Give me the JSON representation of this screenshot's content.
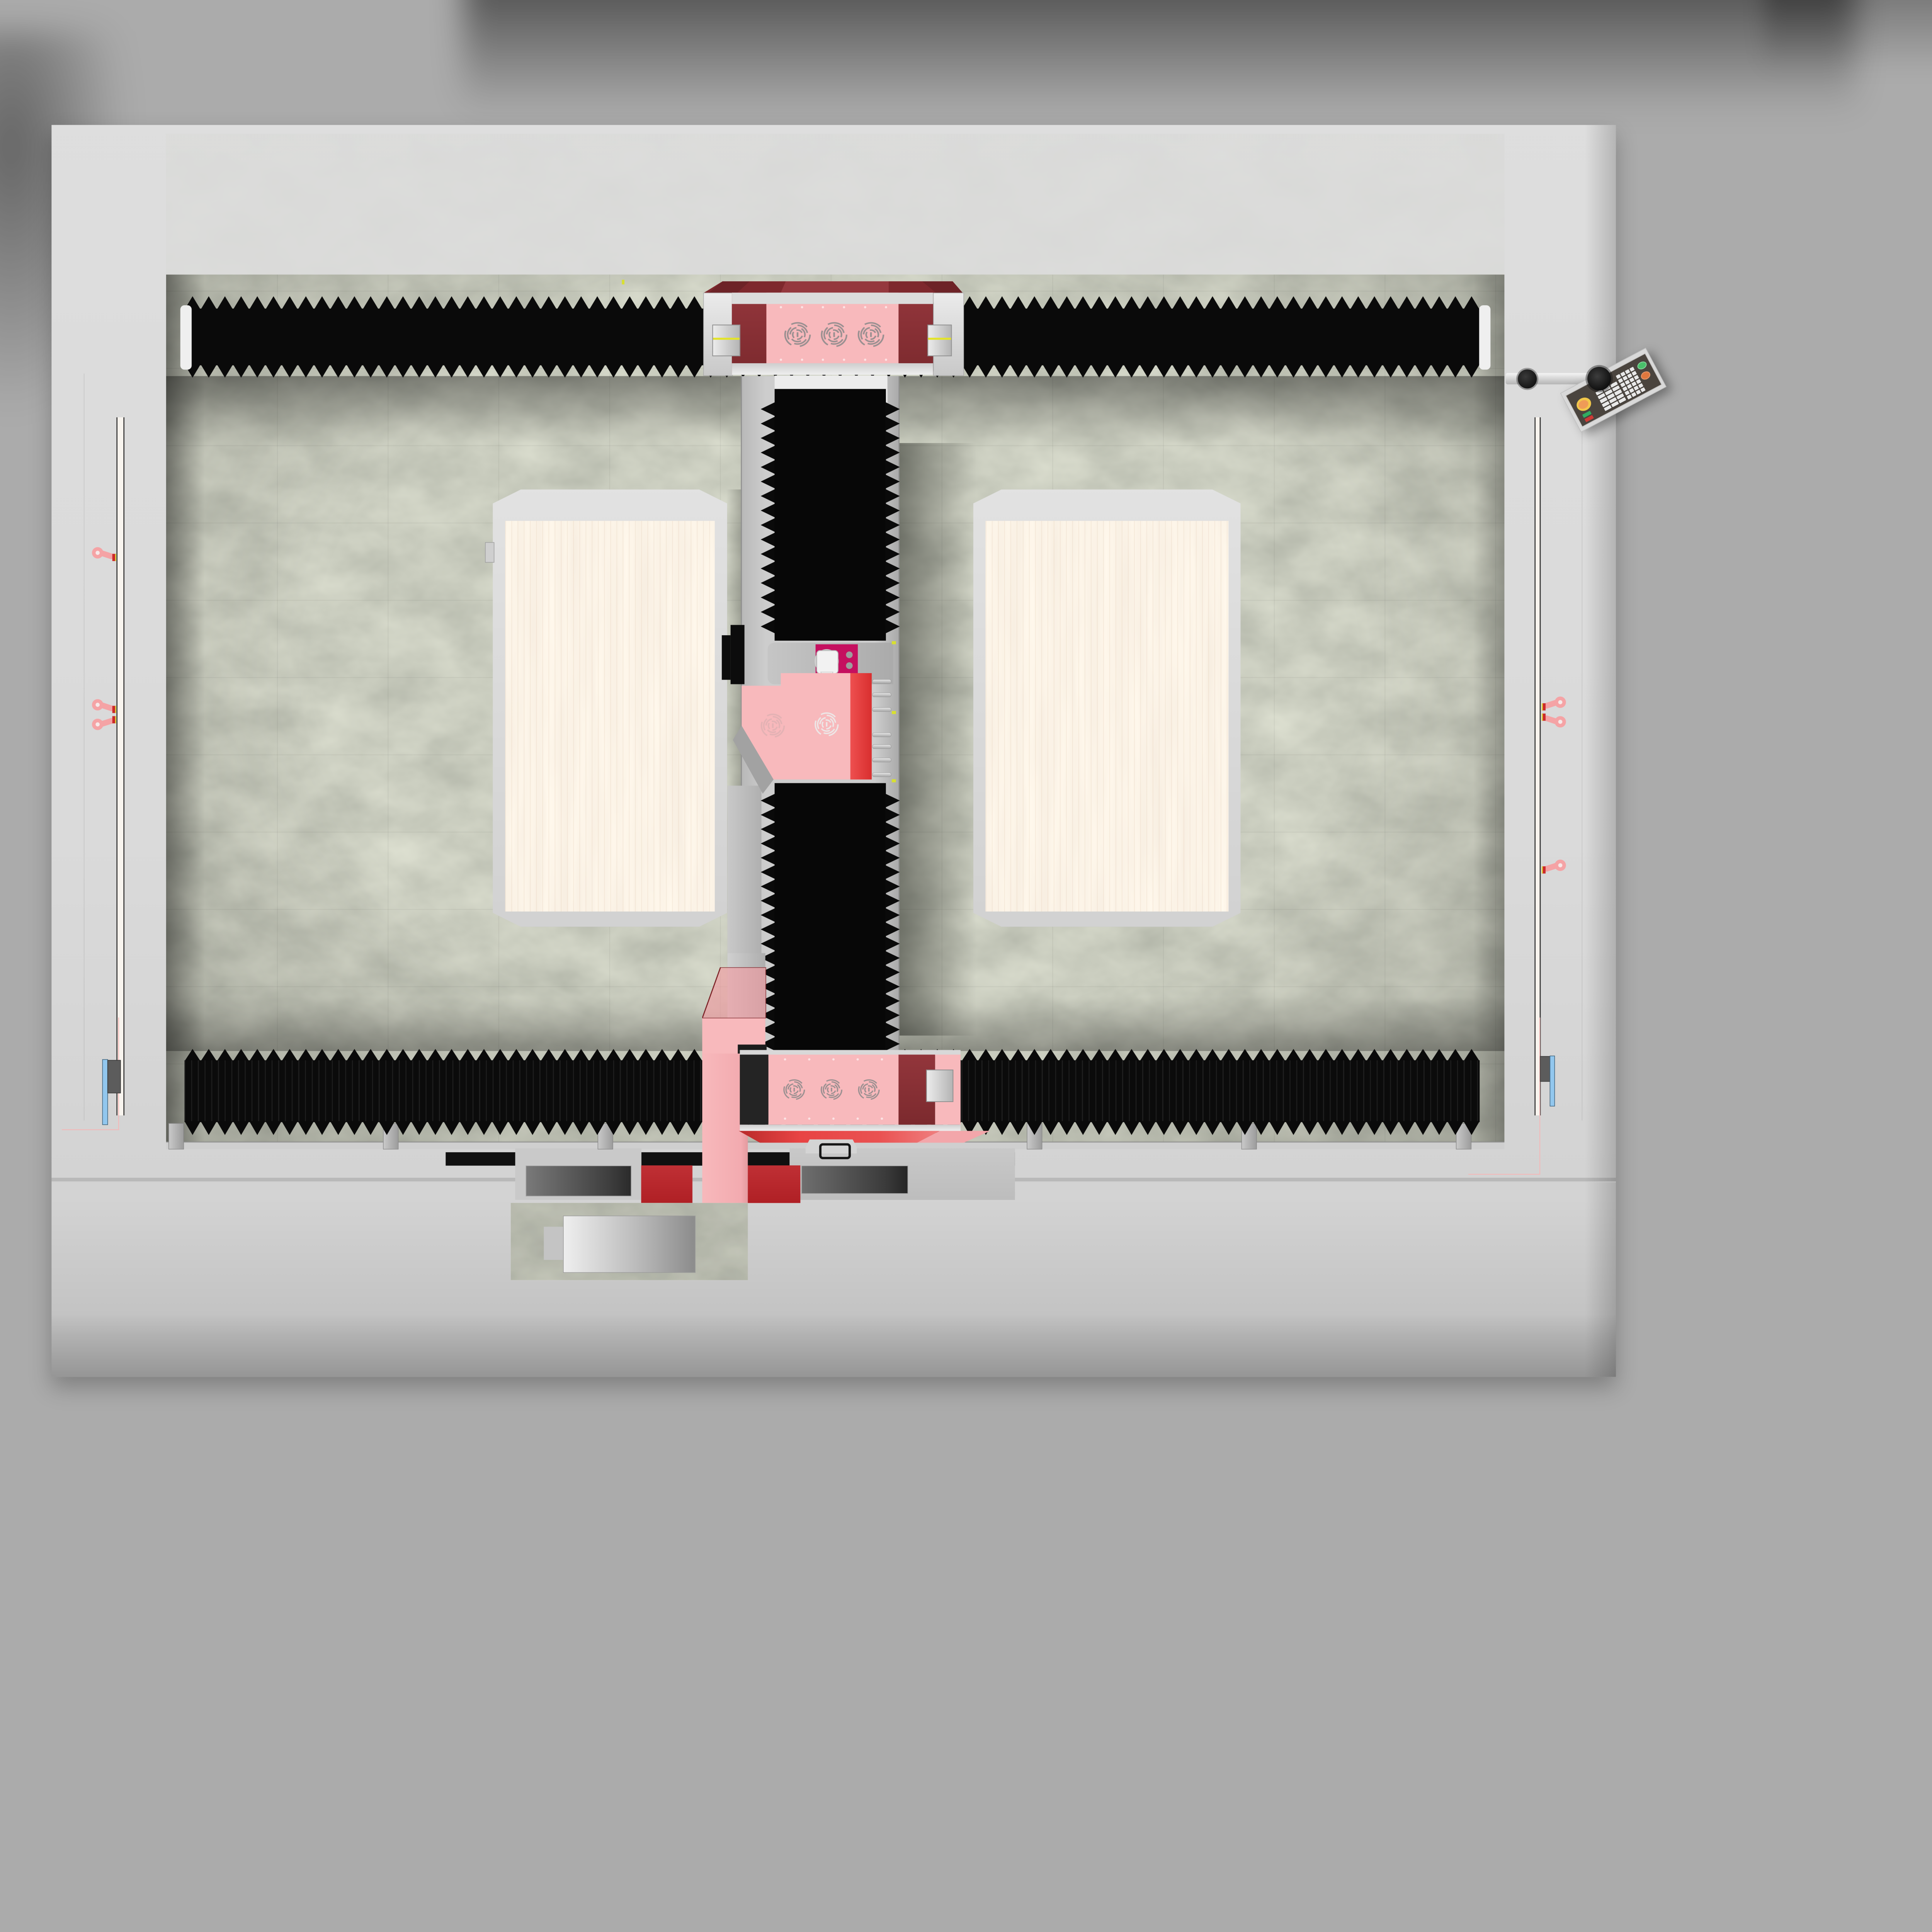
{
  "scene": {
    "description": "Top view 3D render of a dual-table CNC gantry machining centre standing on a light grey base plate",
    "view": "top",
    "text_visible": false
  },
  "colors": {
    "background": "#ababab",
    "floor": "#dcdcdc",
    "floor_front": "#b9b9b9",
    "bed_granite_base": "#91957f",
    "bellows_black": "#0a0a0a",
    "housing_pink": "#f8b9bc",
    "housing_pink_glass": "rgba(242,154,160,0.62)",
    "roof_maroon": "#8e3036",
    "panel_maroon": "#8a3237",
    "accent_red": "#e24343",
    "block_dark_red": "#b02025",
    "spindle_magenta": "#c50f5f",
    "table_wood": "#f8e5cd",
    "table_frame": "#d9d9d9",
    "rail_white": "#f8f4ee",
    "marker_blue": "#92c7ee",
    "eyelet_pink": "#f5a3a5",
    "eyelet_tip_red": "#cc2a2a",
    "clamp_grey": "#d4d4d4",
    "clamp_yellow": "#e3e32a",
    "tick_yellow": "#d8e030",
    "pendant_board": "#d9d9d9",
    "keypad_dark": "#4a443e",
    "key_white": "#e9e9e9",
    "estop_yellow": "#f2c84b",
    "estop_orange": "#ef9b57",
    "button_green": "#49c06a",
    "button_orange": "#e0773e",
    "indicator_green": "#2fae62",
    "indicator_red": "#cc3a35",
    "construction_pink": "#f6b7b7"
  },
  "machine": {
    "bed": {
      "name": "granite machine bed",
      "texture": "mottled green-grey stone"
    },
    "way_covers": {
      "horizontal_bellows": 2,
      "vertical_bellows": 2,
      "edge_style": "sawtooth"
    },
    "tables": [
      {
        "name": "left work table",
        "surface": "wood",
        "shape": "octagonal frame"
      },
      {
        "name": "right work table",
        "surface": "wood",
        "shape": "octagonal frame"
      }
    ],
    "gantry": {
      "top_carriage": {
        "fan_grilles": 3,
        "bearing_clamps": 2,
        "roof": "maroon"
      },
      "bottom_carriage": {
        "fan_grilles": 3,
        "bearing_clamps": 1,
        "front_skirt": "red"
      },
      "z_carriage": {
        "fan_grilles": 2,
        "red_stripe": true,
        "spindle_plate": "magenta",
        "spindle_motor": true
      }
    },
    "side_rails": {
      "left_eye_bolts": 3,
      "right_eye_bolts": 3,
      "corner_markers": "blue bars"
    },
    "front_attachment": {
      "slab": "granite C-slab",
      "insert": "metal plate",
      "cable_bracket": true
    },
    "pendant": {
      "mounted_on": "articulated arm with two black joints",
      "controls": [
        {
          "name": "emergency-stop",
          "color_key": "estop_yellow"
        },
        {
          "name": "green-indicator",
          "color_key": "indicator_green"
        },
        {
          "name": "red-indicator",
          "color_key": "indicator_red"
        },
        {
          "name": "start-button",
          "color_key": "button_green"
        },
        {
          "name": "hold-button",
          "color_key": "button_orange"
        },
        {
          "name": "keypad",
          "keys_visible": 39
        }
      ]
    }
  }
}
